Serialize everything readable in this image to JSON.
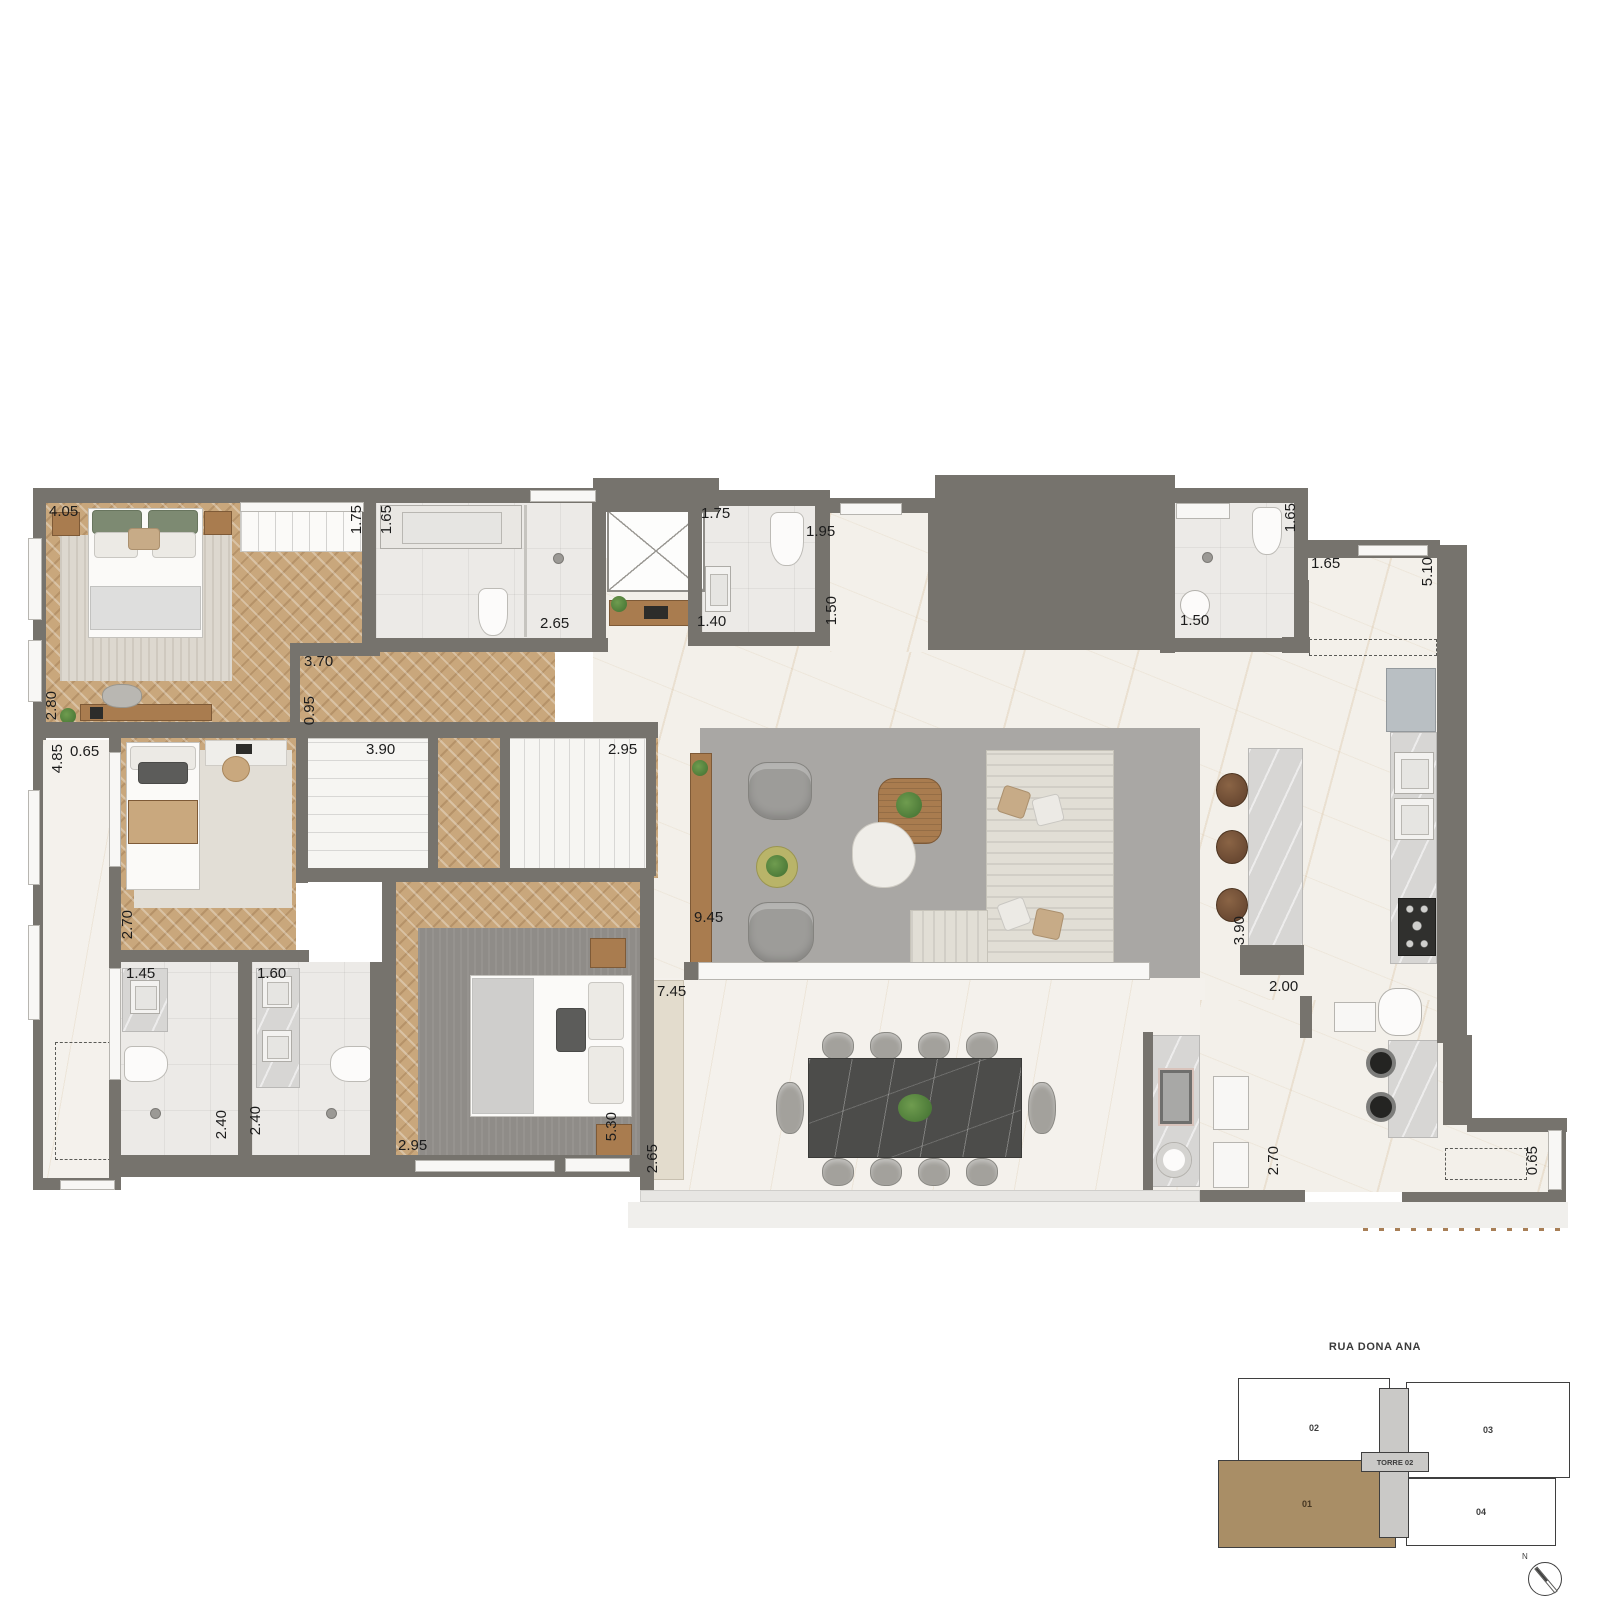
{
  "colors": {
    "wall": "#76736d",
    "wood": "#c9a77c",
    "furnwood": "#a97c4f",
    "marble": "#f3f0ea",
    "marblelight": "#f4f1ec",
    "bath": "#eceae7",
    "rug": "#a9a7a4",
    "rugdark": "#8f8c88",
    "sofa": "#e1ded5",
    "chairgray": "#9d9c99",
    "tabledark": "#4c4c4a",
    "island": "#d7d6d4",
    "stool": "#6b4a33",
    "beige": "#e3dccd",
    "fridge": "#b9bfc3",
    "cab": "#908e89",
    "kpbrown": "#a98e66",
    "kpgray": "#cac9c7",
    "plant": "#4c7a38",
    "label": "#1c1c1c"
  },
  "plan": {
    "dimension_labels": [
      {
        "text": "4.05",
        "x": 49,
        "y": 504,
        "vertical": false
      },
      {
        "text": "1.75",
        "x": 349,
        "y": 505,
        "vertical": true
      },
      {
        "text": "1.65",
        "x": 379,
        "y": 505,
        "vertical": true
      },
      {
        "text": "2.65",
        "x": 540,
        "y": 616,
        "vertical": false
      },
      {
        "text": "3.70",
        "x": 304,
        "y": 654,
        "vertical": false
      },
      {
        "text": "0.95",
        "x": 302,
        "y": 696,
        "vertical": true
      },
      {
        "text": "2.80",
        "x": 44,
        "y": 691,
        "vertical": true
      },
      {
        "text": "4.85",
        "x": 50,
        "y": 744,
        "vertical": true
      },
      {
        "text": "0.65",
        "x": 70,
        "y": 744,
        "vertical": false
      },
      {
        "text": "3.90",
        "x": 366,
        "y": 742,
        "vertical": false
      },
      {
        "text": "2.95",
        "x": 608,
        "y": 742,
        "vertical": false
      },
      {
        "text": "2.70",
        "x": 120,
        "y": 910,
        "vertical": true
      },
      {
        "text": "1.45",
        "x": 126,
        "y": 966,
        "vertical": false
      },
      {
        "text": "1.60",
        "x": 257,
        "y": 966,
        "vertical": false
      },
      {
        "text": "2.40",
        "x": 214,
        "y": 1110,
        "vertical": true
      },
      {
        "text": "2.40",
        "x": 248,
        "y": 1106,
        "vertical": true
      },
      {
        "text": "2.95",
        "x": 398,
        "y": 1138,
        "vertical": false
      },
      {
        "text": "5.30",
        "x": 604,
        "y": 1112,
        "vertical": true
      },
      {
        "text": "2.65",
        "x": 645,
        "y": 1144,
        "vertical": true
      },
      {
        "text": "7.45",
        "x": 657,
        "y": 984,
        "vertical": false
      },
      {
        "text": "1.75",
        "x": 701,
        "y": 506,
        "vertical": false
      },
      {
        "text": "1.40",
        "x": 697,
        "y": 614,
        "vertical": false
      },
      {
        "text": "1.95",
        "x": 806,
        "y": 524,
        "vertical": false
      },
      {
        "text": "1.50",
        "x": 824,
        "y": 596,
        "vertical": true
      },
      {
        "text": "1.65",
        "x": 1283,
        "y": 503,
        "vertical": true
      },
      {
        "text": "1.50",
        "x": 1180,
        "y": 613,
        "vertical": false
      },
      {
        "text": "1.65",
        "x": 1311,
        "y": 556,
        "vertical": false
      },
      {
        "text": "5.10",
        "x": 1420,
        "y": 557,
        "vertical": true
      },
      {
        "text": "9.45",
        "x": 694,
        "y": 910,
        "vertical": false
      },
      {
        "text": "3.90",
        "x": 1232,
        "y": 916,
        "vertical": true
      },
      {
        "text": "2.00",
        "x": 1269,
        "y": 979,
        "vertical": false
      },
      {
        "text": "2.70",
        "x": 1266,
        "y": 1146,
        "vertical": true
      },
      {
        "text": "0.65",
        "x": 1525,
        "y": 1146,
        "vertical": true
      }
    ]
  },
  "keyplan": {
    "street": "RUA DONA ANA",
    "tower_label": "TORRE 02",
    "north_label": "N",
    "units": [
      {
        "label": "02",
        "highlighted": false
      },
      {
        "label": "03",
        "highlighted": false
      },
      {
        "label": "01",
        "highlighted": true
      },
      {
        "label": "04",
        "highlighted": false
      }
    ]
  }
}
